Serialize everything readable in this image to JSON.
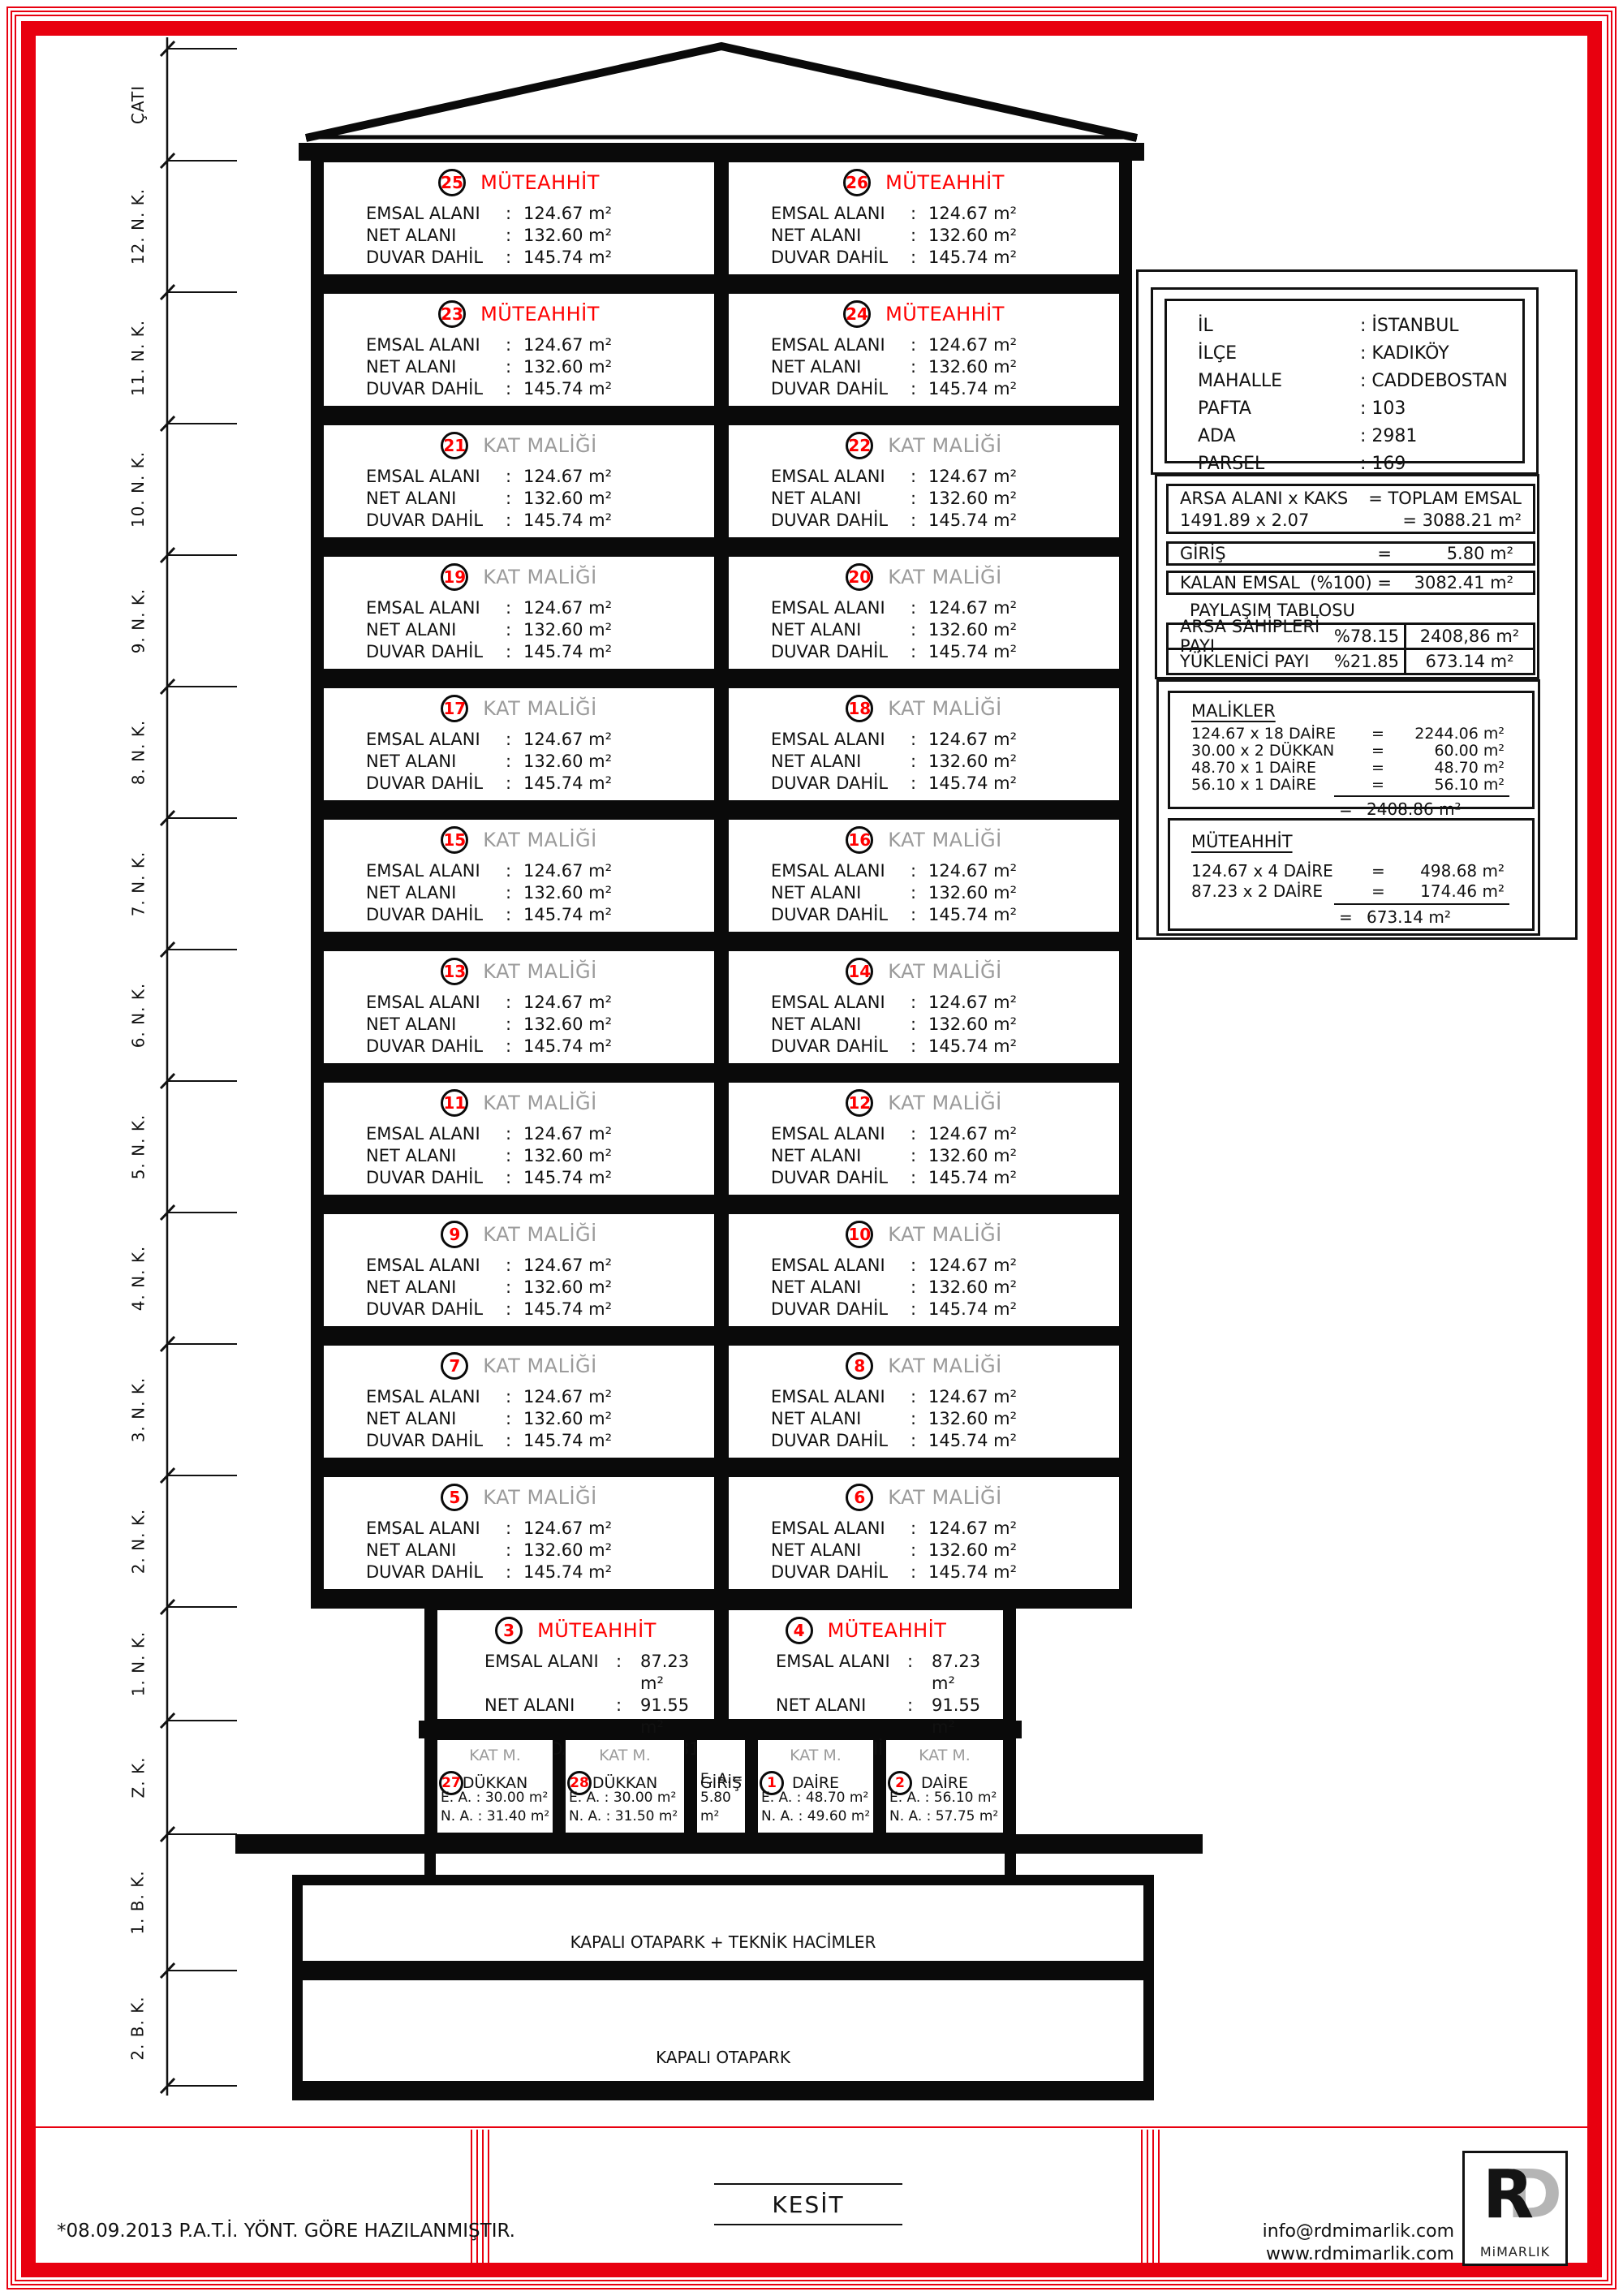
{
  "sep": {
    "colon": ":",
    "eq": "="
  },
  "colors": {
    "accent_red": "#e8000f",
    "owner_red": "#ff0000",
    "muted_gray": "#9b9b9b"
  },
  "dimension_labels": [
    "ÇATI",
    "12. N. K.",
    "11. N. K.",
    "10. N. K.",
    "9. N. K.",
    "8. N. K.",
    "7. N. K.",
    "6. N. K.",
    "5. N. K.",
    "4. N. K.",
    "3. N. K.",
    "2. N. K.",
    "1. N. K.",
    "Z. K.",
    "1. B. K.",
    "2. B. K."
  ],
  "building": {
    "area_labels": {
      "emsal": "EMSAL ALANI",
      "net": "NET ALANI",
      "duvar": "DUVAR DAHİL"
    },
    "floors": [
      {
        "left_no": "25",
        "right_no": "26",
        "type": "MÜTEAHHİT",
        "cls": "owner-red",
        "emsal": "124.67 m²",
        "net": "132.60 m²",
        "duvar": "145.74 m²"
      },
      {
        "left_no": "23",
        "right_no": "24",
        "type": "MÜTEAHHİT",
        "cls": "owner-red",
        "emsal": "124.67 m²",
        "net": "132.60 m²",
        "duvar": "145.74 m²"
      },
      {
        "left_no": "21",
        "right_no": "22",
        "type": "KAT MALİĞİ",
        "cls": "owner-gray",
        "emsal": "124.67 m²",
        "net": "132.60 m²",
        "duvar": "145.74 m²"
      },
      {
        "left_no": "19",
        "right_no": "20",
        "type": "KAT MALİĞİ",
        "cls": "owner-gray",
        "emsal": "124.67 m²",
        "net": "132.60 m²",
        "duvar": "145.74 m²"
      },
      {
        "left_no": "17",
        "right_no": "18",
        "type": "KAT MALİĞİ",
        "cls": "owner-gray",
        "emsal": "124.67 m²",
        "net": "132.60 m²",
        "duvar": "145.74 m²"
      },
      {
        "left_no": "15",
        "right_no": "16",
        "type": "KAT MALİĞİ",
        "cls": "owner-gray",
        "emsal": "124.67 m²",
        "net": "132.60 m²",
        "duvar": "145.74 m²"
      },
      {
        "left_no": "13",
        "right_no": "14",
        "type": "KAT MALİĞİ",
        "cls": "owner-gray",
        "emsal": "124.67 m²",
        "net": "132.60 m²",
        "duvar": "145.74 m²"
      },
      {
        "left_no": "11",
        "right_no": "12",
        "type": "KAT MALİĞİ",
        "cls": "owner-gray",
        "emsal": "124.67 m²",
        "net": "132.60 m²",
        "duvar": "145.74 m²"
      },
      {
        "left_no": "9",
        "right_no": "10",
        "type": "KAT MALİĞİ",
        "cls": "owner-gray",
        "emsal": "124.67 m²",
        "net": "132.60 m²",
        "duvar": "145.74 m²"
      },
      {
        "left_no": "7",
        "right_no": "8",
        "type": "KAT MALİĞİ",
        "cls": "owner-gray",
        "emsal": "124.67 m²",
        "net": "132.60 m²",
        "duvar": "145.74 m²"
      },
      {
        "left_no": "5",
        "right_no": "6",
        "type": "KAT MALİĞİ",
        "cls": "owner-gray",
        "emsal": "124.67 m²",
        "net": "132.60 m²",
        "duvar": "145.74 m²"
      },
      {
        "left_no": "3",
        "right_no": "4",
        "type": "MÜTEAHHİT",
        "cls": "owner-red",
        "emsal": "87.23 m²",
        "net": "91.55 m²",
        "duvar": "100.81 m²"
      }
    ],
    "ground": {
      "cells": [
        {
          "header": "KAT M.",
          "no": "27",
          "label": "DÜKKAN",
          "lines": [
            "E. A. : 30.00 m²",
            "N. A. : 31.40 m²"
          ]
        },
        {
          "header": "KAT M.",
          "no": "28",
          "label": "DÜKKAN",
          "lines": [
            "E. A. : 30.00 m²",
            "N. A. : 31.50 m²"
          ]
        },
        {
          "header": null,
          "no": null,
          "label": "GİRİŞ",
          "lines": [
            "E. A.=",
            "5.80 m²"
          ]
        },
        {
          "header": "KAT M.",
          "no": "1",
          "label": "DAİRE",
          "lines": [
            "E. A. : 48.70 m²",
            "N. A. : 49.60 m²"
          ]
        },
        {
          "header": "KAT M.",
          "no": "2",
          "label": "DAİRE",
          "lines": [
            "E. A. : 56.10 m²",
            "N. A. : 57.75 m²"
          ]
        }
      ]
    },
    "basements": [
      "KAPALI OTAPARK + TEKNİK HACİMLER",
      "KAPALI OTAPARK"
    ]
  },
  "info_panel": {
    "location": [
      {
        "label": "İL",
        "value": ": İSTANBUL"
      },
      {
        "label": "İLÇE",
        "value": ": KADIKÖY"
      },
      {
        "label": "MAHALLE",
        "value": ": CADDEBOSTAN"
      },
      {
        "label": "PAFTA",
        "value": ": 103"
      },
      {
        "label": "ADA",
        "value": ": 2981"
      },
      {
        "label": "PARSEL",
        "value": ": 169"
      }
    ],
    "emsal_calc": {
      "row1_left": "ARSA ALANI x KAKS",
      "row1_right": "= TOPLAM EMSAL",
      "row2_left": "1491.89 x 2.07",
      "row2_right": "= 3088.21 m²",
      "giris_label": "GİRİŞ",
      "giris_eq": "=",
      "giris_value": "5.80 m²",
      "kalan_label": "KALAN EMSAL",
      "kalan_mid": "(%100) =",
      "kalan_value": "3082.41 m²",
      "paylasim_title": "PAYLAŞIM TABLOSU",
      "paylasim_rows": [
        {
          "name": "ARSA SAHİPLERİ PAYI",
          "pct": "%78.15",
          "value": "2408,86 m²"
        },
        {
          "name": "YÜKLENİCİ PAYI",
          "pct": "%21.85",
          "value": "673.14 m²"
        }
      ]
    },
    "malikler": {
      "title": "MALİKLER",
      "rows": [
        {
          "formula": "124.67 x 18 DAİRE",
          "value": "2244.06 m²"
        },
        {
          "formula": "30.00 x 2 DÜKKAN",
          "value": "60.00 m²"
        },
        {
          "formula": "48.70 x 1 DAİRE",
          "value": "48.70 m²"
        },
        {
          "formula": "56.10 x 1 DAİRE",
          "value": "56.10 m²"
        }
      ],
      "total": "2408.86 m²"
    },
    "muteahhit": {
      "title": "MÜTEAHHİT",
      "rows": [
        {
          "formula": "124.67 x 4 DAİRE",
          "value": "498.68 m²"
        },
        {
          "formula": "87.23 x 2 DAİRE",
          "value": "174.46 m²"
        }
      ],
      "total": "673.14 m²"
    }
  },
  "footer": {
    "note": "*08.09.2013 P.A.T.İ. YÖNT. GÖRE HAZILANMIŞTIR.",
    "title": "KESİT",
    "contact_email": "info@rdmimarlik.com",
    "contact_web": "www.rdmimarlik.com",
    "logo_r": "R",
    "logo_d": "D",
    "logo_text": "MiMARLIK"
  }
}
